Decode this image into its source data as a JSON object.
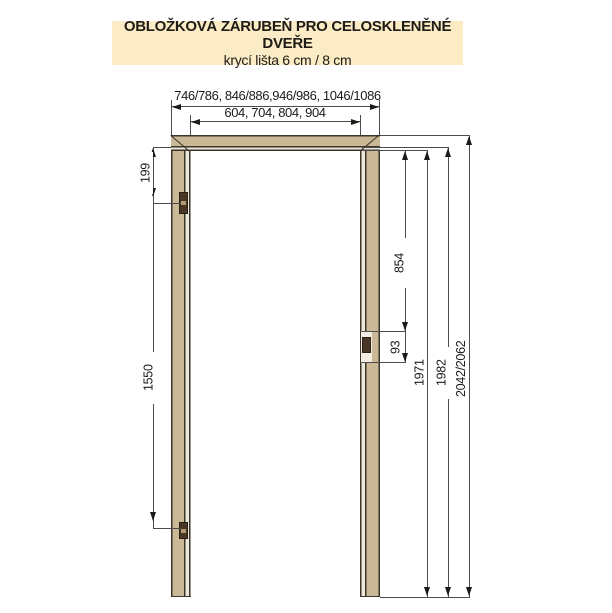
{
  "header": {
    "title": "OBLOŽKOVÁ ZÁRUBEŇ PRO CELOSKLENĚNÉ DVEŘE",
    "subtitle": "krycí lišta 6 cm / 8 cm"
  },
  "dimensions": {
    "outer_widths": "746/786, 846/886,946/986, 1046/1086",
    "clear_widths": "604, 704, 804, 904",
    "hinge_top_offset": "199",
    "hinge_spacing": "1550",
    "strike_offset_from_top": "854",
    "strike_plate_height": "93",
    "clear_height": "1971",
    "frame_rebate_height": "1982",
    "overall_heights": "2042/2062"
  },
  "colors": {
    "header_bg": "#FBECC6",
    "frame_fill": "#CBB897",
    "frame_outline": "#3B3428",
    "rebate_strip": "#EDE8DC",
    "hardware": "#4A3627",
    "dimension_line": "#4C4C4C"
  }
}
